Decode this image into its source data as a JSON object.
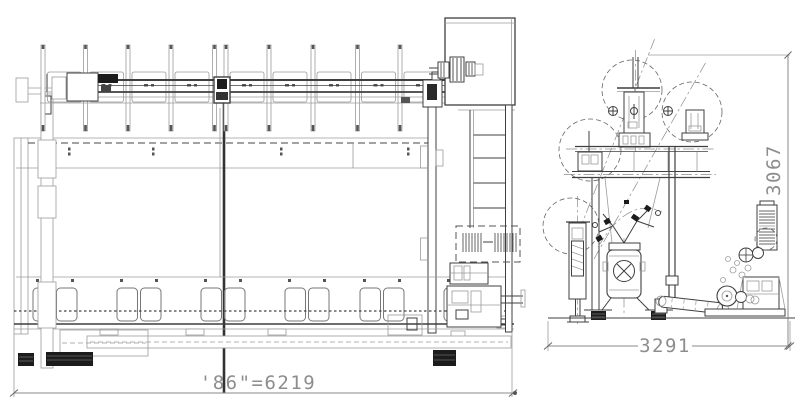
{
  "drawing": {
    "side_view": {
      "width_label": "'86\"=6219"
    },
    "end_view": {
      "width_label": "3291",
      "height_label": "3067"
    },
    "colors": {
      "line_dark": "#3f3f3f",
      "line_light": "#9b9b9b",
      "dimension_text": "#8d8d8d",
      "solid_fill": "#1c1c1c",
      "background": "#ffffff"
    }
  }
}
